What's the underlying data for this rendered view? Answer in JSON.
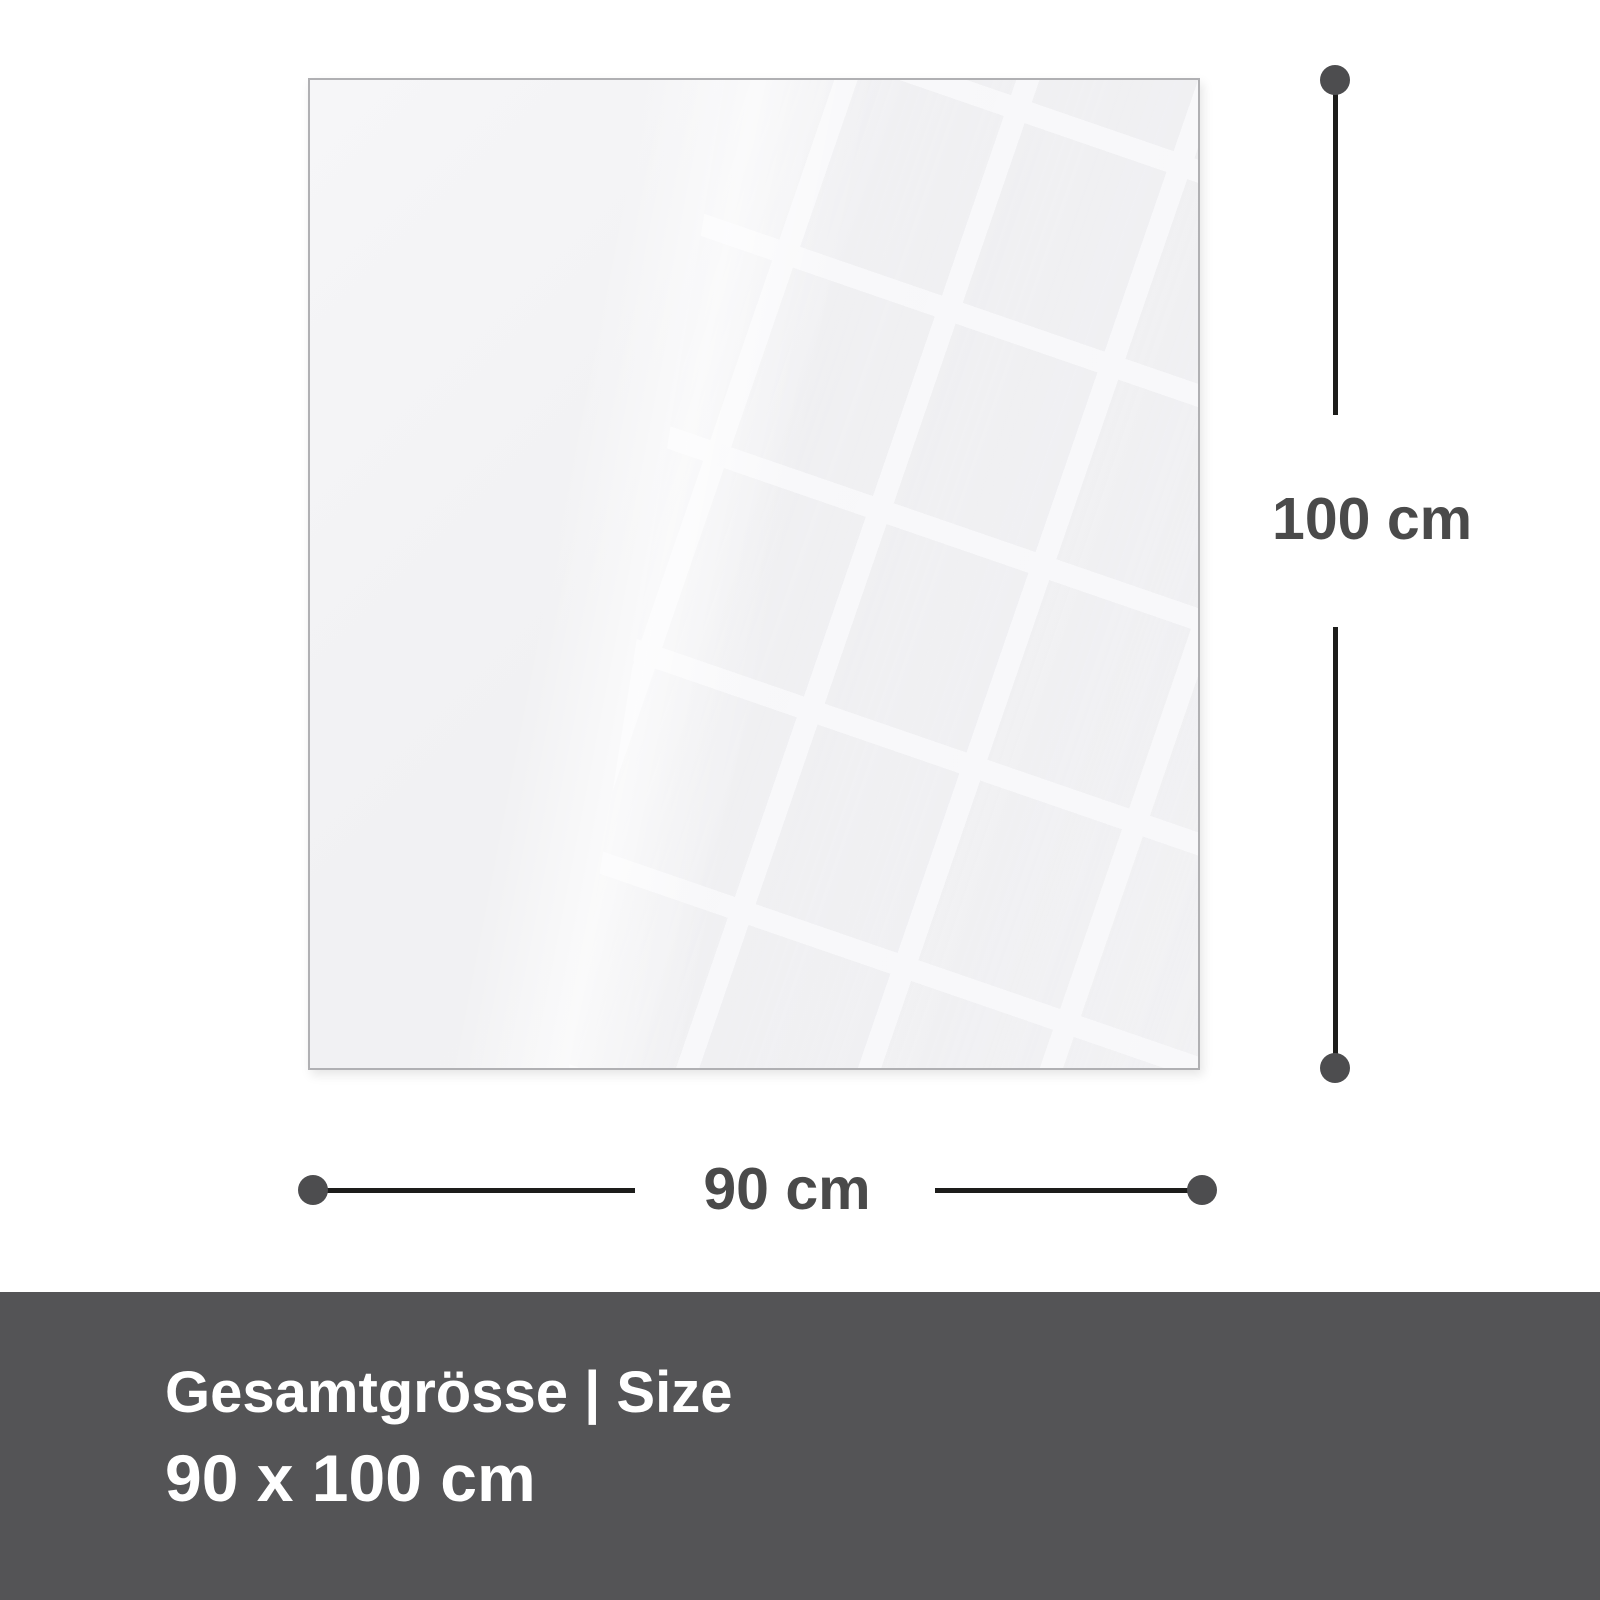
{
  "dimension_labels": {
    "height": "100 cm",
    "width": "90 cm"
  },
  "footer": {
    "heading": "Gesamtgrösse | Size",
    "size": "90 x 100 cm"
  },
  "colors": {
    "page_background": "#ffffff",
    "panel_fill": "#f2f2f4",
    "panel_border": "#b0b0b3",
    "dimension_line": "#1d1d1b",
    "endpoint_dot": "#4d4d4f",
    "dimension_label_text": "#4a4a4a",
    "footer_background": "#545456",
    "footer_text": "#ffffff"
  }
}
